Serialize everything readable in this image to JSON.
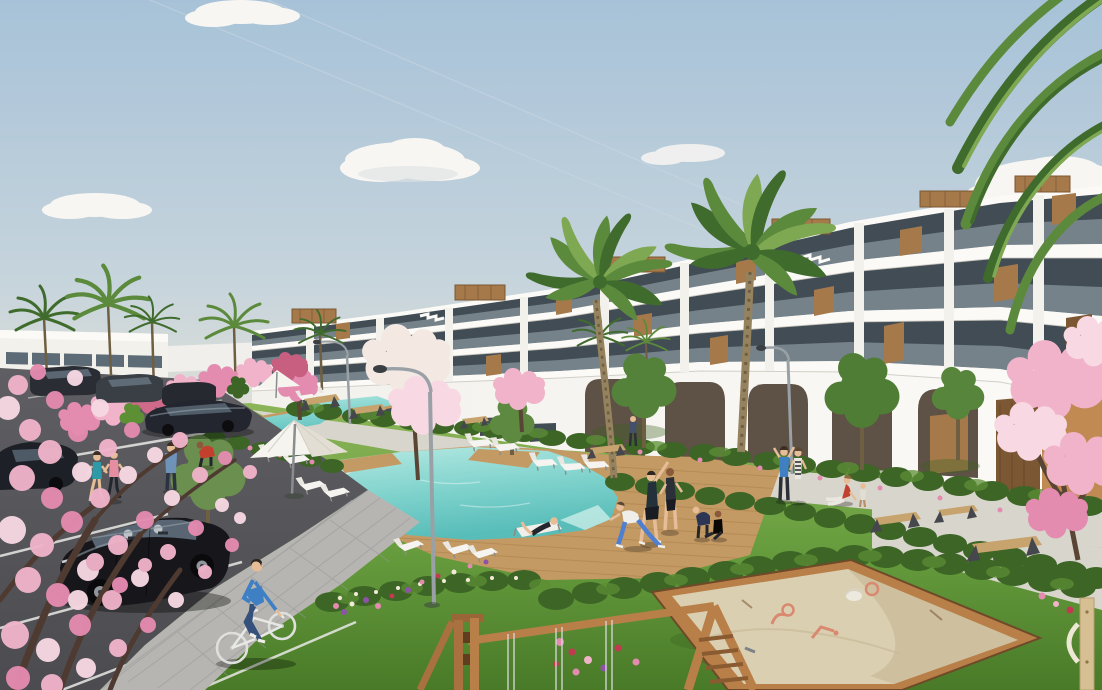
{
  "meta": {
    "title": "New-build residential complex — exterior visualisation",
    "description": "Photorealistic architectural render: white terraced apartment block with wood accents, palm and cherry-blossom trees, communal pools with timber deck and loungers, lawns, playground sandbox and swing frame, parking lot with black hatchback, joggers, yoga group and a cyclist under a pale blue sky."
  },
  "palette": {
    "sky-top": "#a7c2d8",
    "sky-mid": "#c6d4dc",
    "sky-low": "#e7e3d7",
    "cloud": "#f8f6f2",
    "cloud-shade": "#dde2e3",
    "contrail": "#ccd8e2",
    "bldg-white": "#f3f1ec",
    "bldg-bright": "#fbfaf7",
    "bldg-shade": "#dcd8d0",
    "glass-dark": "#414c55",
    "glass-mid": "#5d6b76",
    "balustrade": "#a9b8bf",
    "wood": "#a5794a",
    "wood-dark": "#7c5733",
    "wood-light": "#c59e6b",
    "arch-dark": "#5e5145",
    "wall-orange": "#c08a52",
    "grass-light": "#8cb558",
    "grass-mid": "#679d3e",
    "grass-dark": "#497a28",
    "grass-shadow": "#3a6320",
    "hedge-dark": "#3c6526",
    "hedge-light": "#5d8f35",
    "palm-dark": "#3f6b2d",
    "palm-mid": "#5c8a3c",
    "palm-light": "#7fa852",
    "trunk": "#95825f",
    "trunk-dark": "#6f5f42",
    "blossom-deep": "#e48bb0",
    "blossom-mid": "#f0b3c9",
    "blossom-light": "#f7d8e3",
    "blossom-white": "#f3e9e2",
    "pool-deep": "#58bdb9",
    "pool-mid": "#7fd2cc",
    "pool-light": "#b7e9e3",
    "pool-pale": "#d9f3ee",
    "deck": "#c49a64",
    "deck-dark": "#a67c48",
    "path": "#d8d5cc",
    "paver": "#b6b5b1",
    "paver-dark": "#98979a",
    "asphalt": "#5f5f63",
    "asphalt-dark": "#4c4c50",
    "line-white": "#e9e9e6",
    "car-black": "#17171b",
    "car-glass": "#5f6d7a",
    "car-glint": "#9fb0bb",
    "metal": "#9aa1a6",
    "bench-dark": "#45474c",
    "bench-wood": "#c7a36d",
    "sand": "#dbcfb2",
    "sand-dark": "#c2b28e",
    "play-wood": "#9a6637",
    "play-wood-light": "#b97f49",
    "toy": "#d9896f",
    "skin": "#e6bd97",
    "denim": "#35507a",
    "shirt-blue": "#3f7fc4",
    "teal": "#2e9aa8",
    "pink": "#e58ea2",
    "red": "#c4402e",
    "dark-cloth": "#2b2f38",
    "leggings": "#4f7fd0",
    "white-soft": "#f5f4f0"
  },
  "scene": {
    "sky": {
      "clouds": 7,
      "contrails": 2
    },
    "buildings": [
      {
        "name": "main-apartment-block",
        "floors": 4,
        "features": [
          "terraced balconies",
          "glass balustrades",
          "wood cladding panels",
          "rooftop pergola boxes",
          "tall ground-floor arches"
        ]
      },
      {
        "name": "distant-block-left",
        "floors": 2
      }
    ],
    "water": [
      {
        "name": "main-pool",
        "shape": "irregular with deck steps"
      },
      {
        "name": "lap-pool",
        "shape": "angled lane"
      }
    ],
    "vegetation": {
      "palms": 9,
      "cherry_blossom_trees": 6,
      "green_trees": 5,
      "hedge_rows": 6,
      "flower_beds": 8
    },
    "people": [
      {
        "role": "cyclist"
      },
      {
        "role": "jogger-teal"
      },
      {
        "role": "jogger-pink"
      },
      {
        "role": "man-standing-blue"
      },
      {
        "role": "gardener-red"
      },
      {
        "role": "yoga-stretch-1"
      },
      {
        "role": "yoga-stretch-2"
      },
      {
        "role": "yoga-lunge-woman"
      },
      {
        "role": "person-on-lounger"
      },
      {
        "role": "child-bending"
      },
      {
        "role": "child-sitting"
      },
      {
        "role": "walker-arms-up-blue"
      },
      {
        "role": "walker-striped-top"
      },
      {
        "role": "woman-sitting-path"
      },
      {
        "role": "small-child-path"
      },
      {
        "role": "distant-walker"
      }
    ],
    "vehicles": [
      {
        "type": "hatchback",
        "color": "black",
        "position": "parking foreground"
      },
      {
        "type": "sedan",
        "color": "dark",
        "position": "parking middle"
      },
      {
        "type": "sedan",
        "color": "dark",
        "position": "parking top row"
      },
      {
        "type": "sedan",
        "color": "dark",
        "position": "parking top row"
      },
      {
        "type": "sedan",
        "color": "dark",
        "position": "parking top row"
      },
      {
        "type": "car-partial",
        "color": "black",
        "position": "left edge"
      }
    ],
    "amenities": [
      "swimming-pool",
      "lap-pool",
      "sun-loungers",
      "white-parasol",
      "arched-pergola",
      "street-lamps",
      "angular-benches",
      "sandbox",
      "swing-frame",
      "corner-play-post",
      "parking-lot",
      "paver-walkways"
    ]
  }
}
